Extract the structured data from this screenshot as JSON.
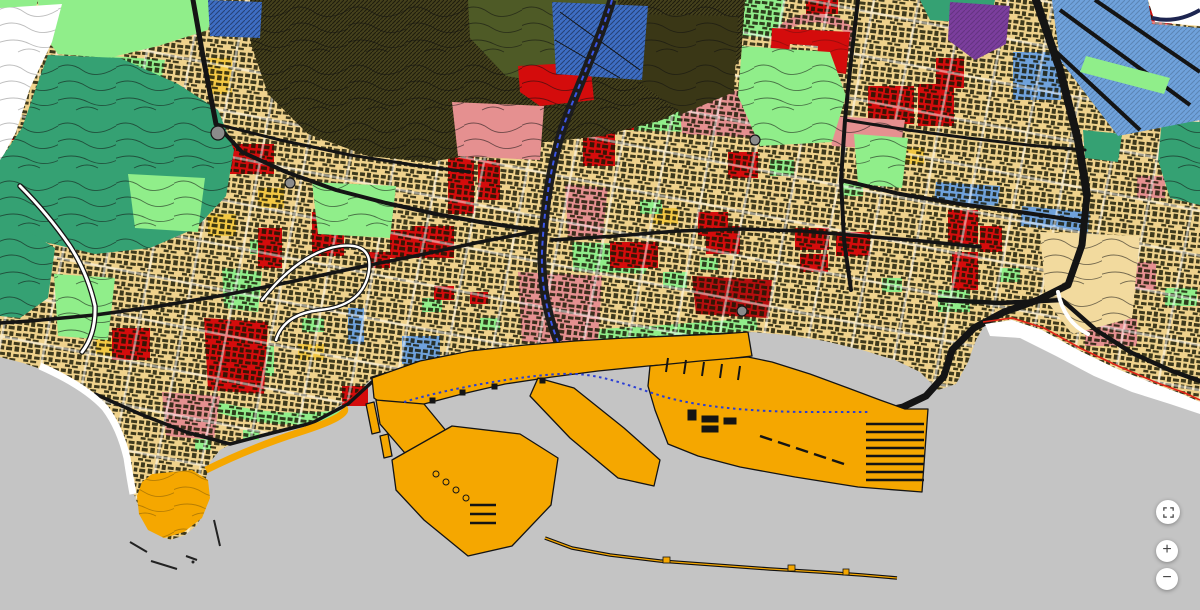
{
  "app": {
    "name": "Zoning map viewer"
  },
  "map": {
    "description": "Urban zoning / land-use map of a Mediterranean port city: hillside green and olive terrain to the north, dense tan urban fabric with red, salmon, blue and green zoning patches, an orange commercial port with breakwaters on the coast, white beaches and a gray sea.",
    "colors": {
      "sea": "#C4C4C4",
      "land_urban": "#EFD28C",
      "land_urban_light": "#F2DA9E",
      "building_marks": "#171703",
      "street_white": "#FFFFFF",
      "yellow_zone": "#F3C844",
      "cream_zone": "#F7F0D0",
      "park_green": "#90EE8A",
      "forest_teal": "#35A173",
      "hill_olive": "#45411C",
      "hill_olive_dark": "#3A3716",
      "hill_darkgreen": "#4E5A26",
      "red_zone": "#D40C0C",
      "dark_red_zone": "#B50E0E",
      "salmon_zone": "#E59090",
      "blue_zone": "#6FA2DC",
      "blue_deep_zone": "#3E6EC4",
      "purple_zone": "#7B3E9D",
      "port_orange": "#F5A700",
      "beach_white": "#FFFFFF",
      "white_zone": "#FFFFFF",
      "road_black": "#141414",
      "road_gray": "#8B8B8B",
      "coastline_red": "#E02417",
      "river_blue": "#3B55E6",
      "boundary_blue": "#2B3FD4",
      "button_bg": "#FFFFFF",
      "button_icon": "#454545"
    }
  },
  "controls": {
    "fullscreen": {
      "label": "Toggle fullscreen"
    },
    "zoom_in": {
      "label": "Zoom in",
      "glyph": "+"
    },
    "zoom_out": {
      "label": "Zoom out",
      "glyph": "−"
    }
  }
}
